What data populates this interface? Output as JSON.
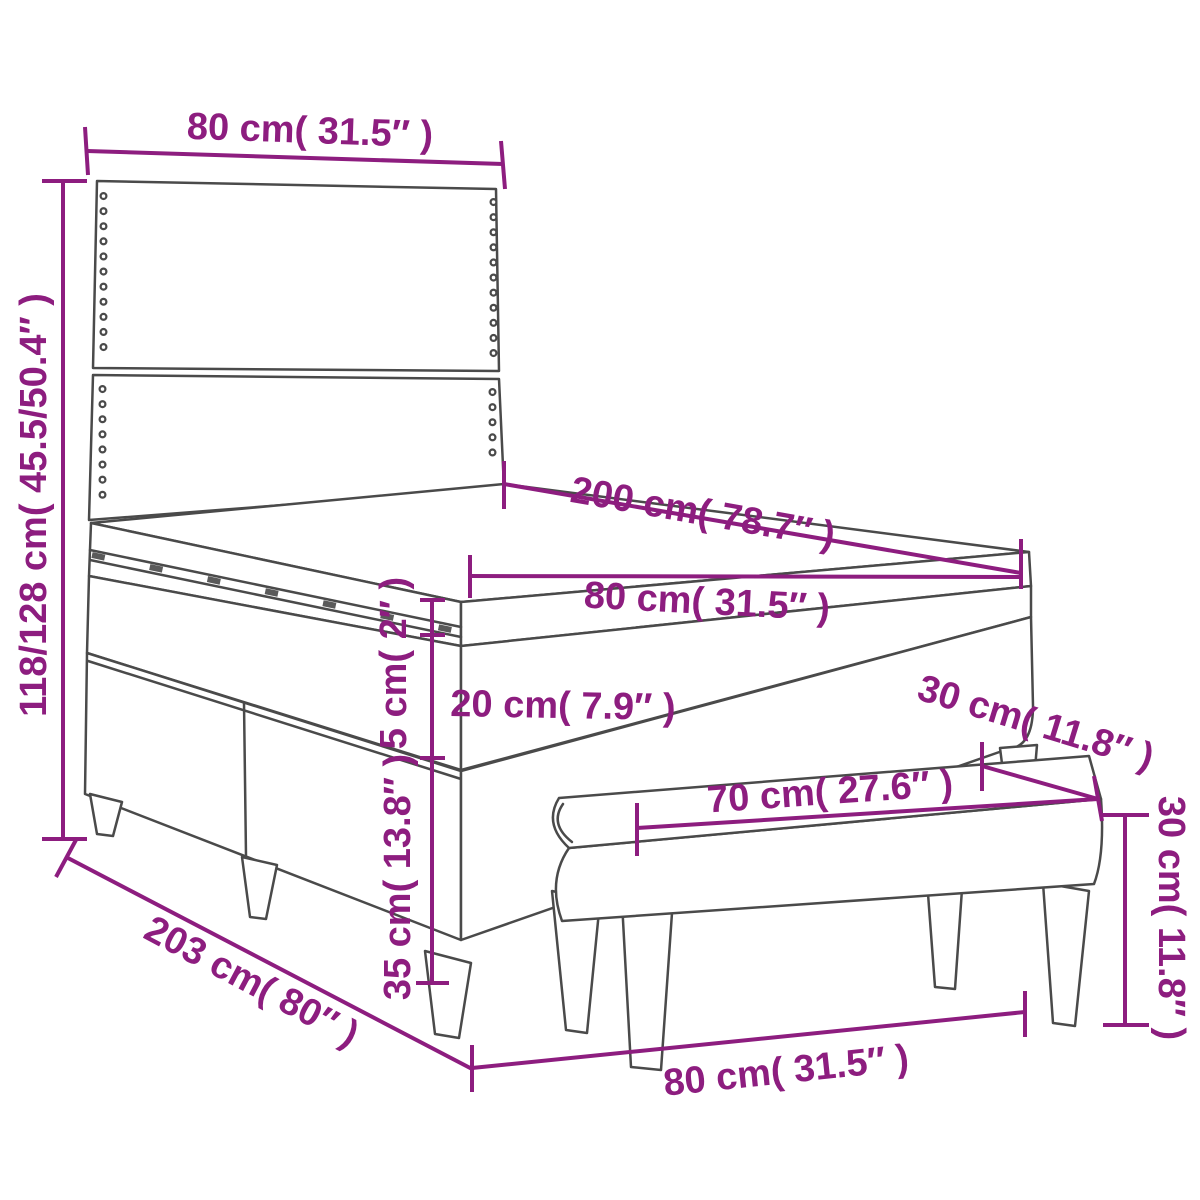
{
  "colors": {
    "dimension_accent": "#8D1D7F",
    "outline": "#4A4A4A",
    "background": "#FFFFFF"
  },
  "dims": {
    "headboard_width": "80 cm( 31.5″ )",
    "overall_height": "118/128 cm( 45.5/50.4″ )",
    "bed_length": "200 cm( 78.7″ )",
    "bed_width": "80 cm( 31.5″ )",
    "topper_thickness": "5 cm( 2″ )",
    "mattress_thickness": "20 cm( 7.9″ )",
    "base_height": "35 cm( 13.8″ )",
    "overall_length": "203 cm( 80″ )",
    "bench_depth": "30 cm( 11.8″ )",
    "bench_length": "70 cm( 27.6″ )",
    "bench_height": "30 cm( 11.8″ )",
    "bench_width": "80 cm( 31.5″ )"
  }
}
